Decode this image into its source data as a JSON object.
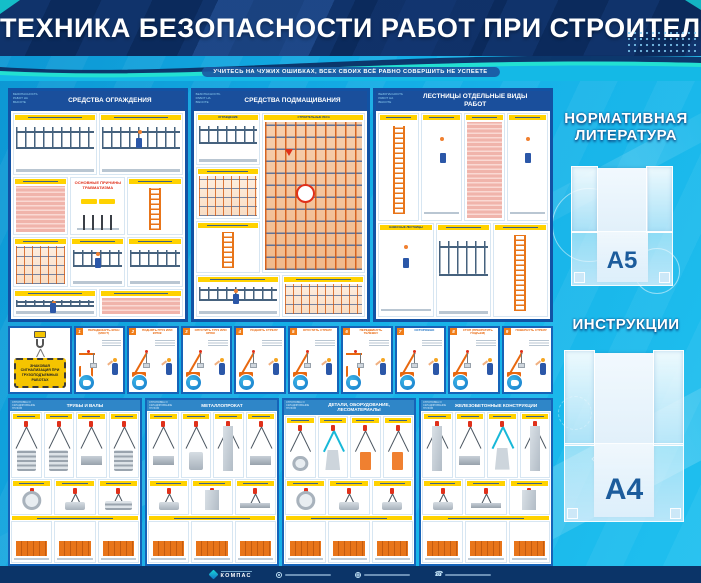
{
  "board": {
    "title": "ТЕХНИКА БЕЗОПАСНОСТИ РАБОТ ПРИ СТРОИТЕЛЬСТВЕ",
    "tagline": "УЧИТЕСЬ НА ЧУЖИХ ОШИБКАХ, ВСЕХ СВОИХ ВСЁ РАВНО СОВЕРШИТЬ НЕ УСПЕЕТЕ"
  },
  "colors": {
    "board_blue": "#14aee6",
    "header_navy": "#0c2c5e",
    "poster_frame_blue": "#1252a4",
    "poster_header_navy": "#1a4f9c",
    "bottom_header_blue": "#2f86c8",
    "accent_yellow": "#ffd200",
    "accent_orange": "#e8680f",
    "accent_red": "#e0301a",
    "accent_cyan": "#19cfe0",
    "footer_navy": "#0b3468",
    "pocket_label_blue": "#1c5c9c"
  },
  "top_posters": [
    {
      "corner": "БЕЗОПАСНОСТЬ РАБОТ НА ВЫСОТЕ",
      "title": "СРЕДСТВА ОГРАЖДЕНИЯ",
      "feature": "ОСНОВНЫЕ ПРИЧИНЫ ТРАВМАТИЗМА"
    },
    {
      "corner": "БЕЗОПАСНОСТЬ РАБОТ НА ВЫСОТЕ",
      "title": "СРЕДСТВА ПОДМАЩИВАНИЯ",
      "sections": [
        "ОГРАЖДЕНИЕ",
        "СТРОИТЕЛЬНЫЕ ЛЕСА"
      ]
    },
    {
      "corner": "БЕЗОПАСНОСТЬ РАБОТ НА ВЫСОТЕ",
      "title": "ЛЕСТНИЦЫ ОТДЕЛЬНЫЕ ВИДЫ РАБОТ",
      "sections": [
        "НАВЕСНЫЕ ЛЕСТНИЦЫ"
      ]
    }
  ],
  "signals": {
    "sign_text": "ЗНАКОВАЯ СИГНАЛИЗАЦИЯ ПРИ ГРУЗОПОДЪЕМНЫХ РАБОТАХ",
    "panels": [
      {
        "num": "1",
        "label": "ПЕРЕДВИНУТЬ КРАН (МОСТ)",
        "gantry": true
      },
      {
        "num": "2",
        "label": "ПОДНЯТЬ ГРУЗ ИЛИ КРЮК"
      },
      {
        "num": "3",
        "label": "ОПУСТИТЬ ГРУЗ ИЛИ КРЮК"
      },
      {
        "num": "4",
        "label": "ПОДНЯТЬ СТРЕЛУ"
      },
      {
        "num": "5",
        "label": "ОПУСТИТЬ СТРЕЛУ"
      },
      {
        "num": "6",
        "label": "ПЕРЕДВИНУТЬ ТЕЛЕЖКУ",
        "gantry": true
      },
      {
        "num": "7",
        "label": "ОСТОРОЖНО",
        "accent": "blue"
      },
      {
        "num": "8",
        "label": "СТОП (ПРЕКРАТИТЬ ПОДЪЕМ)"
      },
      {
        "num": "9",
        "label": "ПОВЕРНУТЬ СТРЕЛУ"
      }
    ]
  },
  "bottom_posters": [
    {
      "corner": "СТРОПОВКА И СКЛАДИРОВАНИЕ ГРУЗОВ",
      "title": "ТРУБЫ И ВАЛЫ"
    },
    {
      "corner": "СТРОПОВКА И СКЛАДИРОВАНИЕ ГРУЗОВ",
      "title": "МЕТАЛЛОПРОКАТ"
    },
    {
      "corner": "СТРОПОВКА И СКЛАДИРОВАНИЕ ГРУЗОВ",
      "title": "ДЕТАЛИ, ОБОРУДОВАНИЕ, ЛЕСОМАТЕРИАЛЫ"
    },
    {
      "corner": "СТРОПОВКА И СКЛАДИРОВАНИЕ ГРУЗОВ",
      "title": "ЖЕЛЕЗОБЕТОННЫЕ КОНСТРУКЦИИ"
    }
  ],
  "pockets": [
    {
      "heading": "НОРМАТИВНАЯ ЛИТЕРАТУРА",
      "size_label": "А5"
    },
    {
      "heading": "ИНСТРУКЦИИ",
      "size_label": "А4"
    }
  ],
  "footer": {
    "logo_text": "КОМПАС",
    "contacts": [
      {
        "icon": "location-icon"
      },
      {
        "icon": "website-icon"
      },
      {
        "icon": "phone-icon"
      }
    ]
  }
}
